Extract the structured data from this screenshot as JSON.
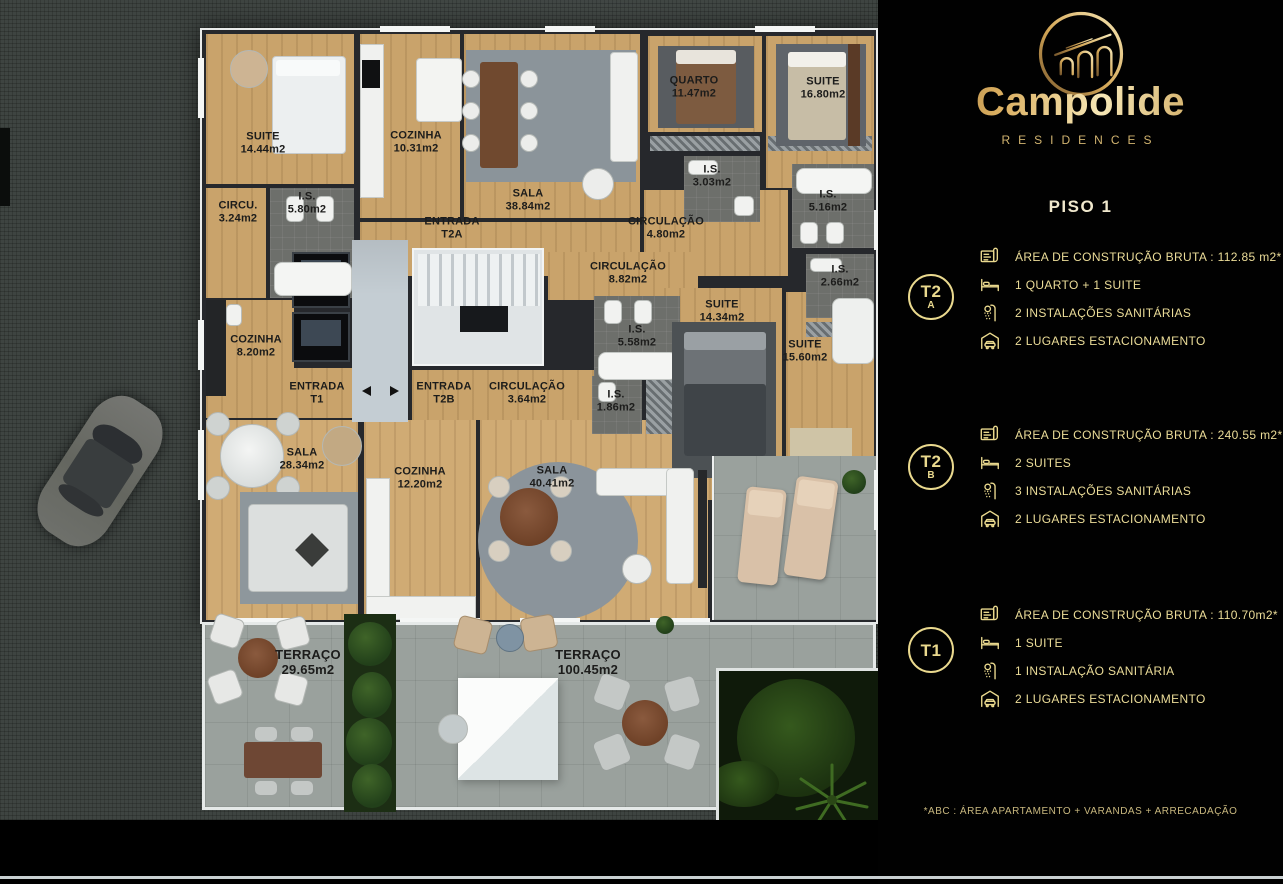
{
  "brand": {
    "name": "Campolide",
    "tagline": "RESIDENCES"
  },
  "floor_title": "PISO 1",
  "footnote": "*ABC :  ÁREA APARTAMENTO + VARANDAS + ARRECADAÇÃO",
  "colors": {
    "accent_gold": "#ead98e",
    "wood_floor": "#c9a36b",
    "terrace_stone": "#9aa19d",
    "panel_bg": "#000000"
  },
  "units": [
    {
      "id": "T2A",
      "badge_main": "T2",
      "badge_sub": "A",
      "specs": [
        {
          "icon": "blueprint-icon",
          "text": "ÁREA DE CONSTRUÇÃO BRUTA :  112.85 m2*"
        },
        {
          "icon": "bed-icon",
          "text": "1 QUARTO + 1 SUITE"
        },
        {
          "icon": "shower-icon",
          "text": "2 INSTALAÇÕES SANITÁRIAS"
        },
        {
          "icon": "garage-icon",
          "text": "2 LUGARES ESTACIONAMENTO"
        }
      ]
    },
    {
      "id": "T2B",
      "badge_main": "T2",
      "badge_sub": "B",
      "specs": [
        {
          "icon": "blueprint-icon",
          "text": "ÁREA DE CONSTRUÇÃO BRUTA :  240.55 m2*"
        },
        {
          "icon": "bed-icon",
          "text": "2 SUITES"
        },
        {
          "icon": "shower-icon",
          "text": "3 INSTALAÇÕES SANITÁRIAS"
        },
        {
          "icon": "garage-icon",
          "text": "2 LUGARES ESTACIONAMENTO"
        }
      ]
    },
    {
      "id": "T1",
      "badge_main": "T1",
      "badge_sub": "",
      "specs": [
        {
          "icon": "blueprint-icon",
          "text": "ÁREA DE CONSTRUÇÃO BRUTA :  110.70m2*"
        },
        {
          "icon": "bed-icon",
          "text": "1 SUITE"
        },
        {
          "icon": "shower-icon",
          "text": "1 INSTALAÇÃO SANITÁRIA"
        },
        {
          "icon": "garage-icon",
          "text": "2 LUGARES ESTACIONAMENTO"
        }
      ]
    }
  ],
  "floorplan": {
    "labels": [
      {
        "lines": [
          "SUITE",
          "14.44m2"
        ],
        "x": 263,
        "y": 143
      },
      {
        "lines": [
          "COZINHA",
          "10.31m2"
        ],
        "x": 416,
        "y": 142
      },
      {
        "lines": [
          "SALA",
          "38.84m2"
        ],
        "x": 528,
        "y": 200
      },
      {
        "lines": [
          "QUARTO",
          "11.47m2"
        ],
        "x": 694,
        "y": 87
      },
      {
        "lines": [
          "SUITE",
          "16.80m2"
        ],
        "x": 823,
        "y": 88
      },
      {
        "lines": [
          "I.S.",
          "3.03m2"
        ],
        "x": 712,
        "y": 176
      },
      {
        "lines": [
          "I.S.",
          "5.80m2"
        ],
        "x": 307,
        "y": 203
      },
      {
        "lines": [
          "CIRCU.",
          "3.24m2"
        ],
        "x": 238,
        "y": 212
      },
      {
        "lines": [
          "ENTRADA",
          "T2A"
        ],
        "x": 452,
        "y": 228
      },
      {
        "lines": [
          "CIRCULAÇÃO",
          "4.80m2"
        ],
        "x": 666,
        "y": 228
      },
      {
        "lines": [
          "I.S.",
          "5.16m2"
        ],
        "x": 828,
        "y": 201
      },
      {
        "lines": [
          "CIRCULAÇÃO",
          "8.82m2"
        ],
        "x": 628,
        "y": 273
      },
      {
        "lines": [
          "I.S.",
          "2.66m2"
        ],
        "x": 840,
        "y": 276
      },
      {
        "lines": [
          "SUITE",
          "14.34m2"
        ],
        "x": 722,
        "y": 311
      },
      {
        "lines": [
          "I.S.",
          "5.58m2"
        ],
        "x": 637,
        "y": 336
      },
      {
        "lines": [
          "SUITE",
          "15.60m2"
        ],
        "x": 805,
        "y": 351
      },
      {
        "lines": [
          "COZINHA",
          "8.20m2"
        ],
        "x": 256,
        "y": 346
      },
      {
        "lines": [
          "ENTRADA",
          "T1"
        ],
        "x": 317,
        "y": 393
      },
      {
        "lines": [
          "ENTRADA",
          "T2B"
        ],
        "x": 444,
        "y": 393
      },
      {
        "lines": [
          "CIRCULAÇÃO",
          "3.64m2"
        ],
        "x": 527,
        "y": 393
      },
      {
        "lines": [
          "I.S.",
          "1.86m2"
        ],
        "x": 616,
        "y": 401
      },
      {
        "lines": [
          "SALA",
          "28.34m2"
        ],
        "x": 302,
        "y": 459
      },
      {
        "lines": [
          "COZINHA",
          "12.20m2"
        ],
        "x": 420,
        "y": 478
      },
      {
        "lines": [
          "SALA",
          "40.41m2"
        ],
        "x": 552,
        "y": 477
      },
      {
        "lines": [
          "TERRAÇO",
          "29.65m2"
        ],
        "x": 308,
        "y": 663,
        "size": 13
      },
      {
        "lines": [
          "TERRAÇO",
          "100.45m2"
        ],
        "x": 588,
        "y": 663,
        "size": 13
      }
    ]
  }
}
